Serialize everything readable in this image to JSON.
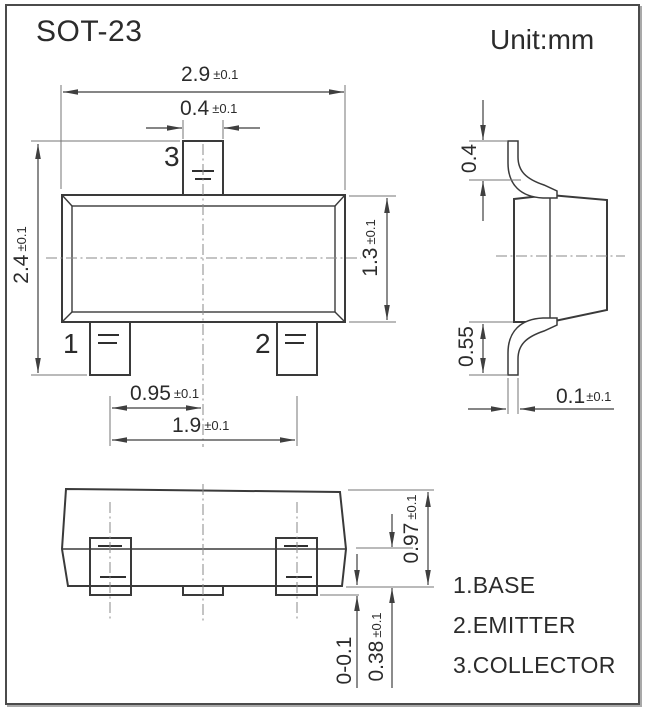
{
  "title": "SOT-23",
  "unit": "Unit:mm",
  "front": {
    "dim_body_width": {
      "value": "2.9",
      "tol": "±0.1"
    },
    "dim_lead_width": {
      "value": "0.4",
      "tol": "±0.1"
    },
    "dim_overall_height": {
      "value": "2.4",
      "tol": "±0.1"
    },
    "dim_body_height": {
      "value": "1.3",
      "tol": "±0.1"
    },
    "dim_lead_pitch": {
      "value": "0.95",
      "tol": "±0.1"
    },
    "dim_lead_span": {
      "value": "1.9",
      "tol": "±0.1"
    },
    "pin1": "1",
    "pin2": "2",
    "pin3": "3"
  },
  "side": {
    "dim_lead_top_height": {
      "value": "0.4",
      "tol": ""
    },
    "dim_lead_bottom_height": {
      "value": "0.55",
      "tol": ""
    },
    "dim_lead_thickness": {
      "value": "0.1",
      "tol": "±0.1"
    }
  },
  "bottom": {
    "dim_pad_height": {
      "value": "0.97",
      "tol": "±0.1"
    },
    "dim_pad_protrusion": {
      "value": "0-0.1",
      "tol": ""
    },
    "dim_pad_width": {
      "value": "0.38",
      "tol": "±0.1"
    }
  },
  "legend": {
    "items": [
      {
        "label": "1.BASE"
      },
      {
        "label": "2.EMITTER"
      },
      {
        "label": "3.COLLECTOR"
      }
    ]
  },
  "colors": {
    "line": "#3a3a3a",
    "dimension": "#3f3f3f",
    "extension": "#757575",
    "centerline": "#8a8a8a",
    "text": "#2b2b2b",
    "background": "#ffffff"
  }
}
